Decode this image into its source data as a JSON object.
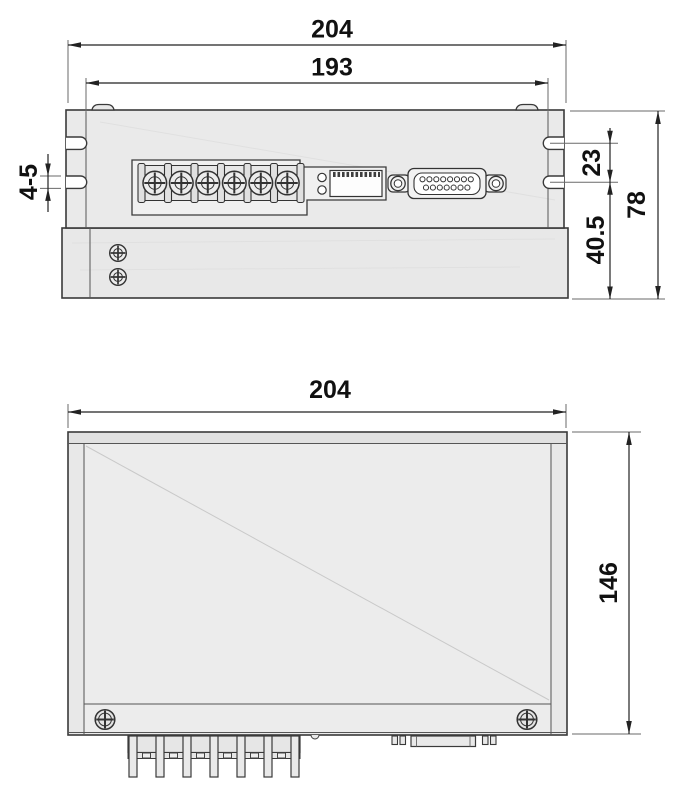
{
  "top_view": {
    "overall_width": "204",
    "mount_width": "193",
    "slot_width": "4-5",
    "slot_offset": "23",
    "base_height": "40.5",
    "overall_height": "78"
  },
  "front_view": {
    "overall_width": "204",
    "overall_height": "146"
  },
  "colors": {
    "line": "#3a3a3a",
    "body_fill": "#e8e8e8",
    "panel_fill": "#f0f0f0",
    "dim_line": "#222222",
    "text": "#111111",
    "background": "#ffffff"
  }
}
